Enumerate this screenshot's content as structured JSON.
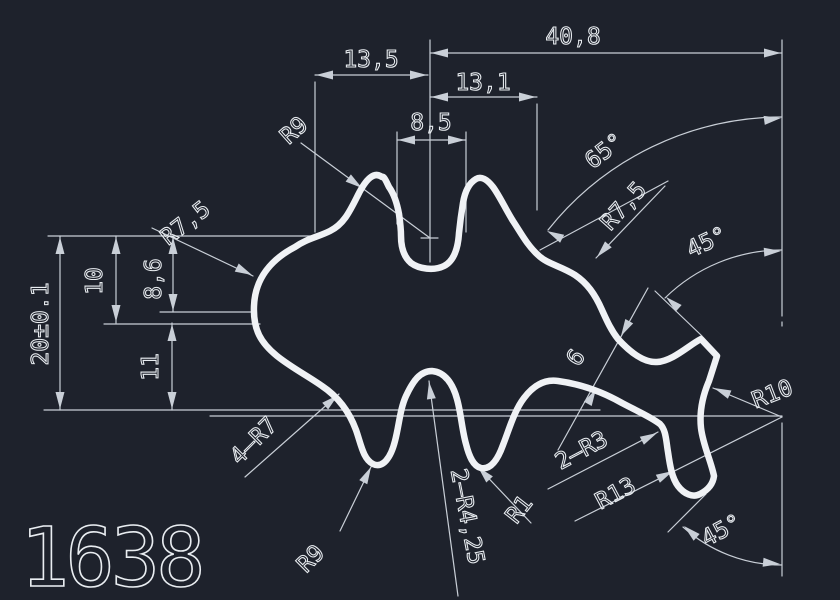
{
  "drawing": {
    "part_number": "1638",
    "linear_dimensions": {
      "top_width": "40,8",
      "upper_left_width": "13,5",
      "upper_mid_width": "13,1",
      "slot_width": "8,5",
      "overall_height": "20±0.1",
      "height_upper": "10",
      "height_left": "8,6",
      "height_lower": "11",
      "arm_thickness": "6"
    },
    "radii": {
      "top_left_lobe": "R9",
      "left_upper": "R7,5",
      "right_upper": "R7,5",
      "right_notch": "R10",
      "foot_inner": "R13",
      "bottom_lobe": "R9",
      "bottom_fillets": "4–R7",
      "bottom_grooves": "2–R4,25",
      "groove_tip": "R1",
      "leg_corners": "2–R3"
    },
    "angles": {
      "upper_slope": "65°",
      "tip_chamfer": "45°",
      "foot_chamfer": "45°"
    }
  },
  "colors": {
    "background": "#1e222c",
    "geometry": "#f0f2f5",
    "dimensions": "#c9cfd7",
    "text": "#e9edf1"
  }
}
